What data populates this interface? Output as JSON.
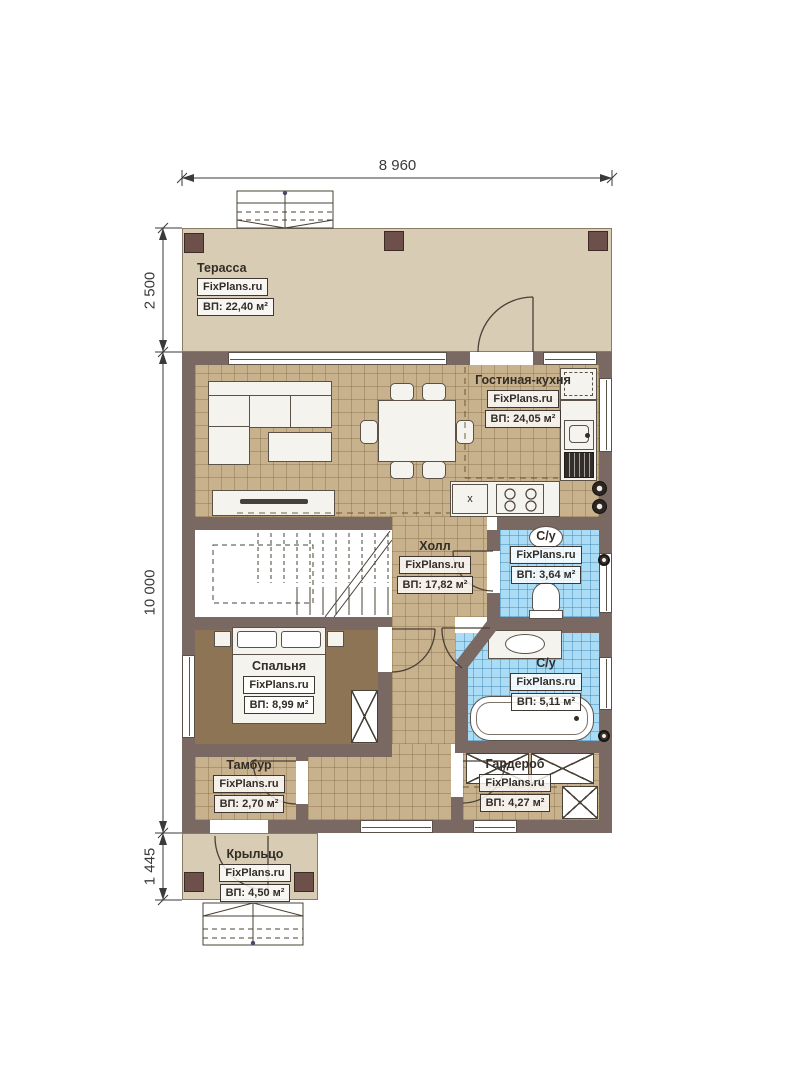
{
  "brand": "FixPlans.ru",
  "dimensions": {
    "width_top": "8 960",
    "terrace_depth": "2 500",
    "house_depth": "10 000",
    "porch_depth": "1 445"
  },
  "rooms": {
    "terrace": {
      "name": "Терасса",
      "area": "ВП: 22,40 м²"
    },
    "living": {
      "name": "Гостиная-кухня",
      "area": "ВП: 24,05 м²"
    },
    "hall": {
      "name": "Холл",
      "area": "ВП: 17,82 м²"
    },
    "wc_top": {
      "name": "С/у",
      "area": "ВП: 3,64 м²"
    },
    "wc_main": {
      "name": "С/у",
      "area": "ВП: 5,11 м²"
    },
    "bedroom": {
      "name": "Спальня",
      "area": "ВП: 8,99 м²"
    },
    "tambour": {
      "name": "Тамбур",
      "area": "ВП: 2,70 м²"
    },
    "wardrobe": {
      "name": "Гардероб",
      "area": "ВП: 4,27 м²"
    },
    "porch": {
      "name": "Крыльцо",
      "area": "ВП: 4,50 м²"
    }
  },
  "labels": {
    "boiler": "x"
  },
  "colors": {
    "wall": "#7a6862",
    "terrace_floor": "#d9ccb5",
    "tile_floor": "#c8b28d",
    "bedroom_floor": "#8c7454",
    "bath_tile": "#aadcf5",
    "column": "#6d5049",
    "line": "#4a4036"
  }
}
